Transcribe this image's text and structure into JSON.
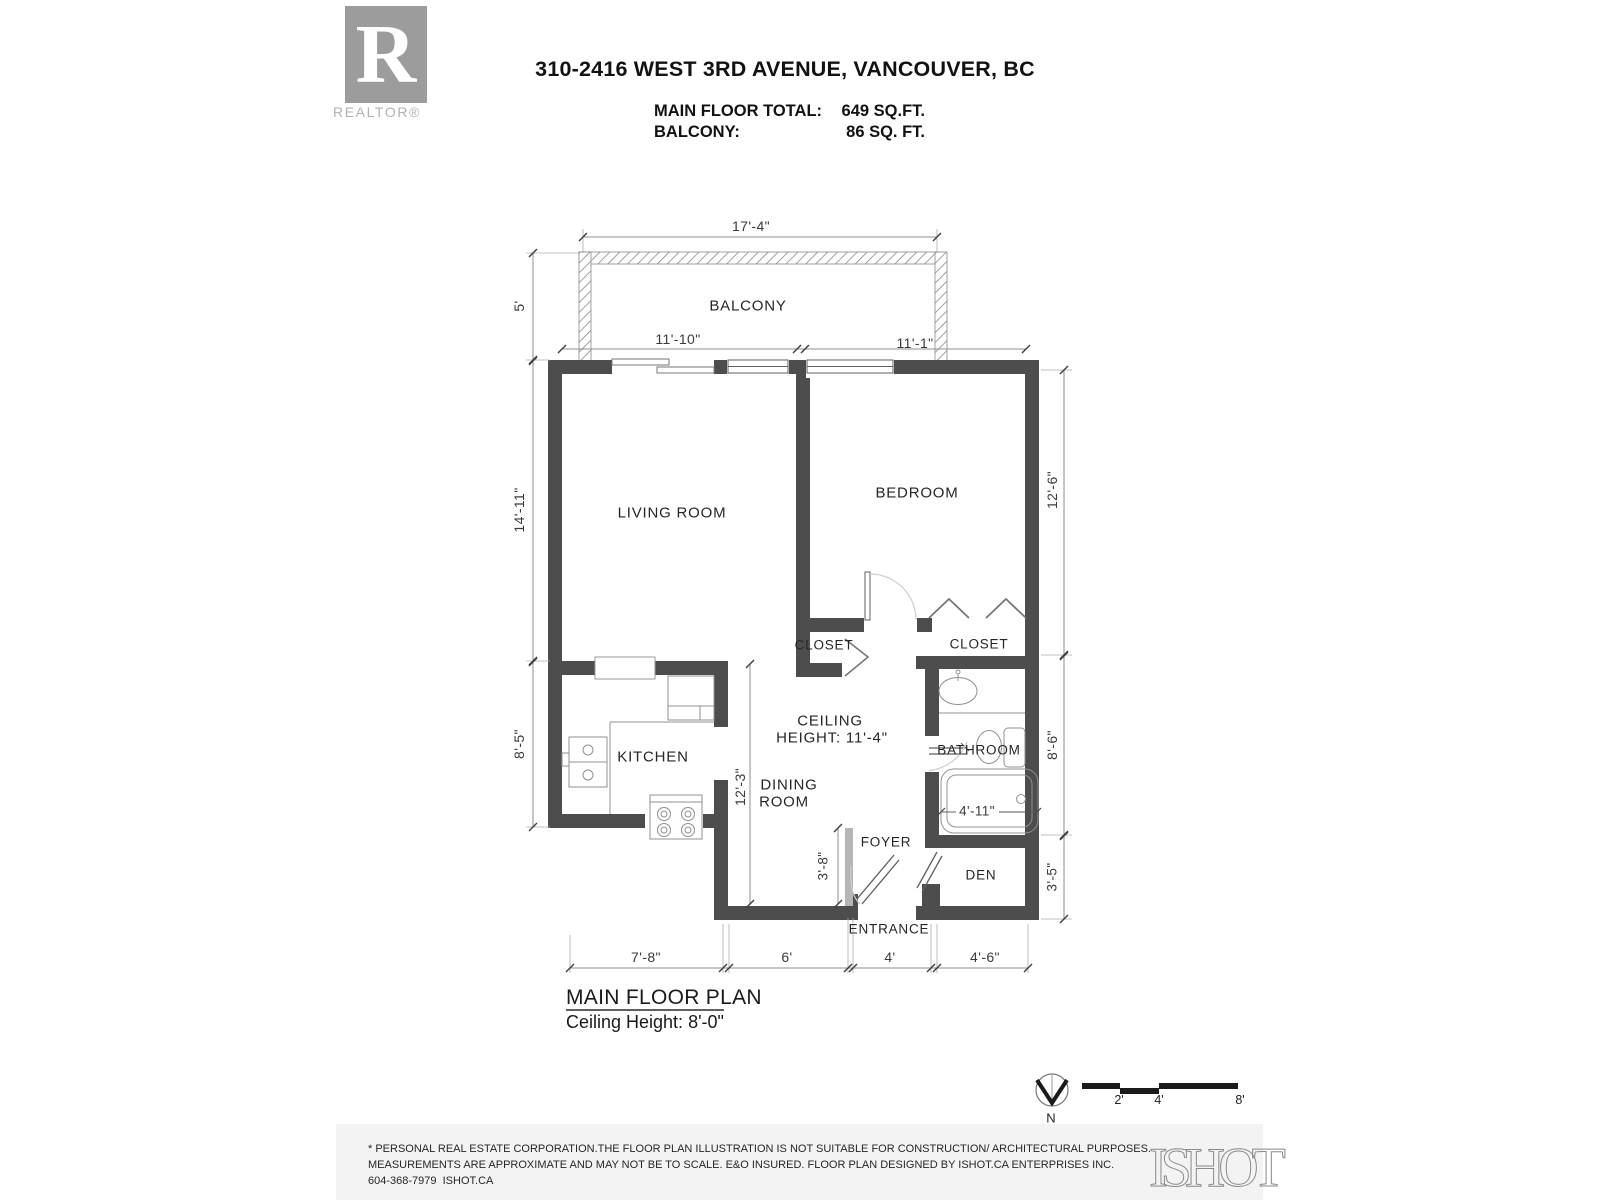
{
  "header": {
    "title": "310-2416 WEST 3RD AVENUE, VANCOUVER, BC",
    "areas": {
      "main_label": "MAIN FLOOR TOTAL:",
      "main_value": "649 SQ.FT.",
      "balcony_label": "BALCONY:",
      "balcony_value": "86 SQ. FT."
    }
  },
  "branding": {
    "realtor_letter": "R",
    "realtor_wordmark": "REALTOR®",
    "ishot_wordmark": "ISHOT"
  },
  "rooms": {
    "balcony": "BALCONY",
    "living": "LIVING ROOM",
    "bedroom": "BEDROOM",
    "closet_left": "CLOSET",
    "closet_right": "CLOSET",
    "kitchen": "KITCHEN",
    "dining_1": "DINING",
    "dining_2": "ROOM",
    "bathroom": "BATHROOM",
    "foyer": "FOYER",
    "den": "DEN",
    "entrance": "ENTRANCE"
  },
  "notes": {
    "ceiling_1": "CEILING",
    "ceiling_2": "HEIGHT: 11'-4\""
  },
  "dims": {
    "balcony_w": "17'-4\"",
    "balcony_d": "5'",
    "living_w": "11'-10\"",
    "bedroom_w": "11'-1\"",
    "living_h": "14'-11\"",
    "bedroom_h": "12'-6\"",
    "kitchen_h": "8'-5\"",
    "dining_h": "12'-3\"",
    "bathroom_h": "8'-6\"",
    "tub_w": "4'-11\"",
    "foyer_h": "3'-8\"",
    "den_h": "3'-5\"",
    "bottom_1": "7'-8\"",
    "bottom_2": "6'",
    "bottom_3": "4'",
    "bottom_4": "4'-6\""
  },
  "plan_title": {
    "line1": "MAIN FLOOR PLAN",
    "line2": "Ceiling Height: 8'-0\""
  },
  "compass": {
    "north": "N"
  },
  "scale_bar": {
    "t2": "2'",
    "t4": "4'",
    "t8": "8'"
  },
  "footer": {
    "line1": "* PERSONAL REAL ESTATE CORPORATION.THE FLOOR PLAN ILLUSTRATION IS NOT SUITABLE FOR CONSTRUCTION/ ARCHITECTURAL PURPOSES.",
    "line2": "MEASUREMENTS ARE APPROXIMATE AND MAY NOT BE TO SCALE. E&O INSURED. FLOOR PLAN DESIGNED BY ISHOT.CA ENTERPRISES INC.",
    "line3": "604-368-7979  ISHOT.CA"
  },
  "colors": {
    "wall": "#4d4d4d",
    "pony_wall": "#b5b5b5",
    "thin_line": "#8f8f8f",
    "footer_bg": "#f3f3f3",
    "logo_gray": "#9c9c9c"
  }
}
